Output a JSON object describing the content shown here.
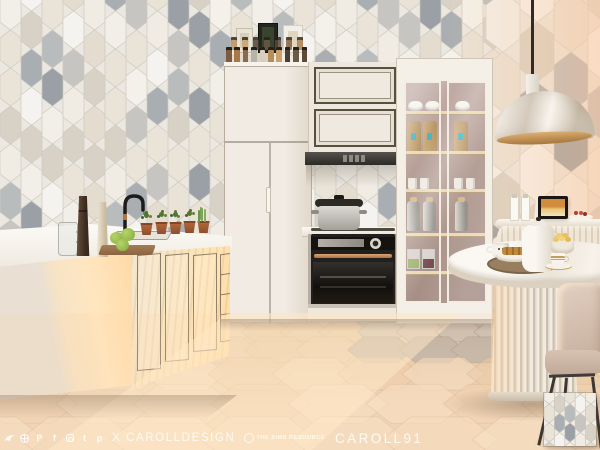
{
  "watermark": {
    "social_icons": [
      "tsr-bird-icon",
      "globe-icon",
      "patreon-icon",
      "facebook-icon",
      "instagram-icon",
      "tumblr-icon",
      "pinterest-icon"
    ],
    "patreon_letter": "P",
    "facebook_letter": "f",
    "tumblr_letter": "t",
    "pinterest_letter": "p",
    "creator_text": "X CAROLLDESIGN",
    "brand_badge_text": "THE SIMS RESOURCE",
    "author_text": "CAROLL91",
    "text_color_rgba": "rgba(255,255,255,0.82)"
  },
  "swatch": {
    "description": "hexagon picket wall tile pattern swatch"
  },
  "palette": {
    "wall_hex_colors": [
      "#f2efe9",
      "#f5f3ef",
      "#eae4d8",
      "#e3dccf",
      "#f1ece3",
      "#a9aeb2",
      "#c6c5c2",
      "#e9e2d6",
      "#9aa0a5",
      "#d8d2c6",
      "#f4f1ea",
      "#b9bcbd"
    ],
    "wall_grout": "#cfc9c0",
    "floor_base": "#e6caae",
    "floor_tints": [
      "rgba(240,216,188,0.6)",
      "rgba(233,204,172,0.6)",
      "rgba(245,224,200,0.6)",
      "rgba(228,196,162,0.55)"
    ],
    "floor_gray_tints": [
      "#b7b3af",
      "#aeaaa6",
      "#c1bdb9"
    ],
    "floor_line": "rgba(176,140,105,0.35)",
    "cabinet_cream": "#efe8df",
    "counter_white": "#faf8f3",
    "oven_dark": "#26221f",
    "copper_accent": "#c58f5f",
    "terracotta": "#b0613f",
    "vitrine_back": "#b49a94",
    "sunlight": "#ffdfb4",
    "gold_accent": "#c79a5e",
    "spice_colors": [
      "#b98d5a",
      "#8a6a48",
      "#5d4a38",
      "#caa06b",
      "#b8b3a8",
      "#7d5b3e",
      "#4a3e33",
      "#d9cdbb",
      "#a87848",
      "#6b5a44"
    ]
  }
}
